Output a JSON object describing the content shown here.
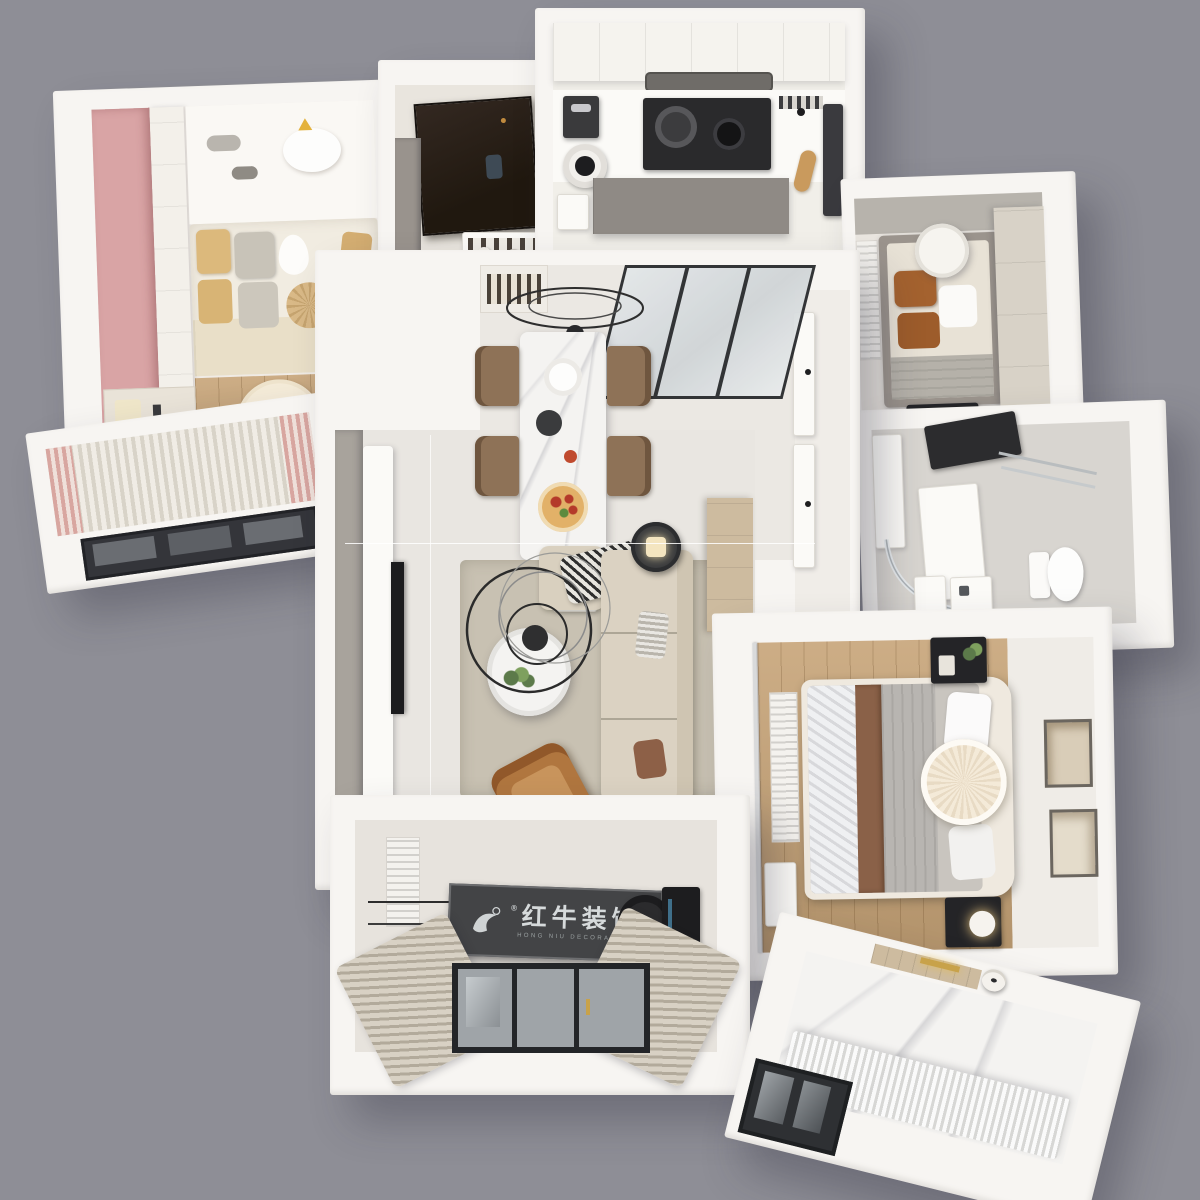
{
  "watermark": {
    "registered_mark": "®",
    "brand_cn": "红牛装饰",
    "brand_en": "HONG NIU DECORATION"
  },
  "palette": {
    "background": "#8e8e96",
    "wall_white": "#f7f5f2",
    "floor_tile": "#eae7e2",
    "wood_floor": "#c7a478",
    "accent_pink": "#d9a4a5",
    "sofa_cream": "#dbd2c2",
    "rug_beige": "#c8c1b2",
    "leather_caramel": "#b0763f",
    "cabinet_gray": "#97928c",
    "wardrobe_beige": "#d6d0c5",
    "bedding_gray": "#b8b5b1",
    "pillow_brown": "#a4622f",
    "pillow_tan": "#dcb97c",
    "entry_door_dark": "#2b211b",
    "banner_dark": "#434446",
    "window_frame_black": "#232528",
    "rug_orange": "#e8873a",
    "kids_rug_cream": "#f5ecd9"
  }
}
